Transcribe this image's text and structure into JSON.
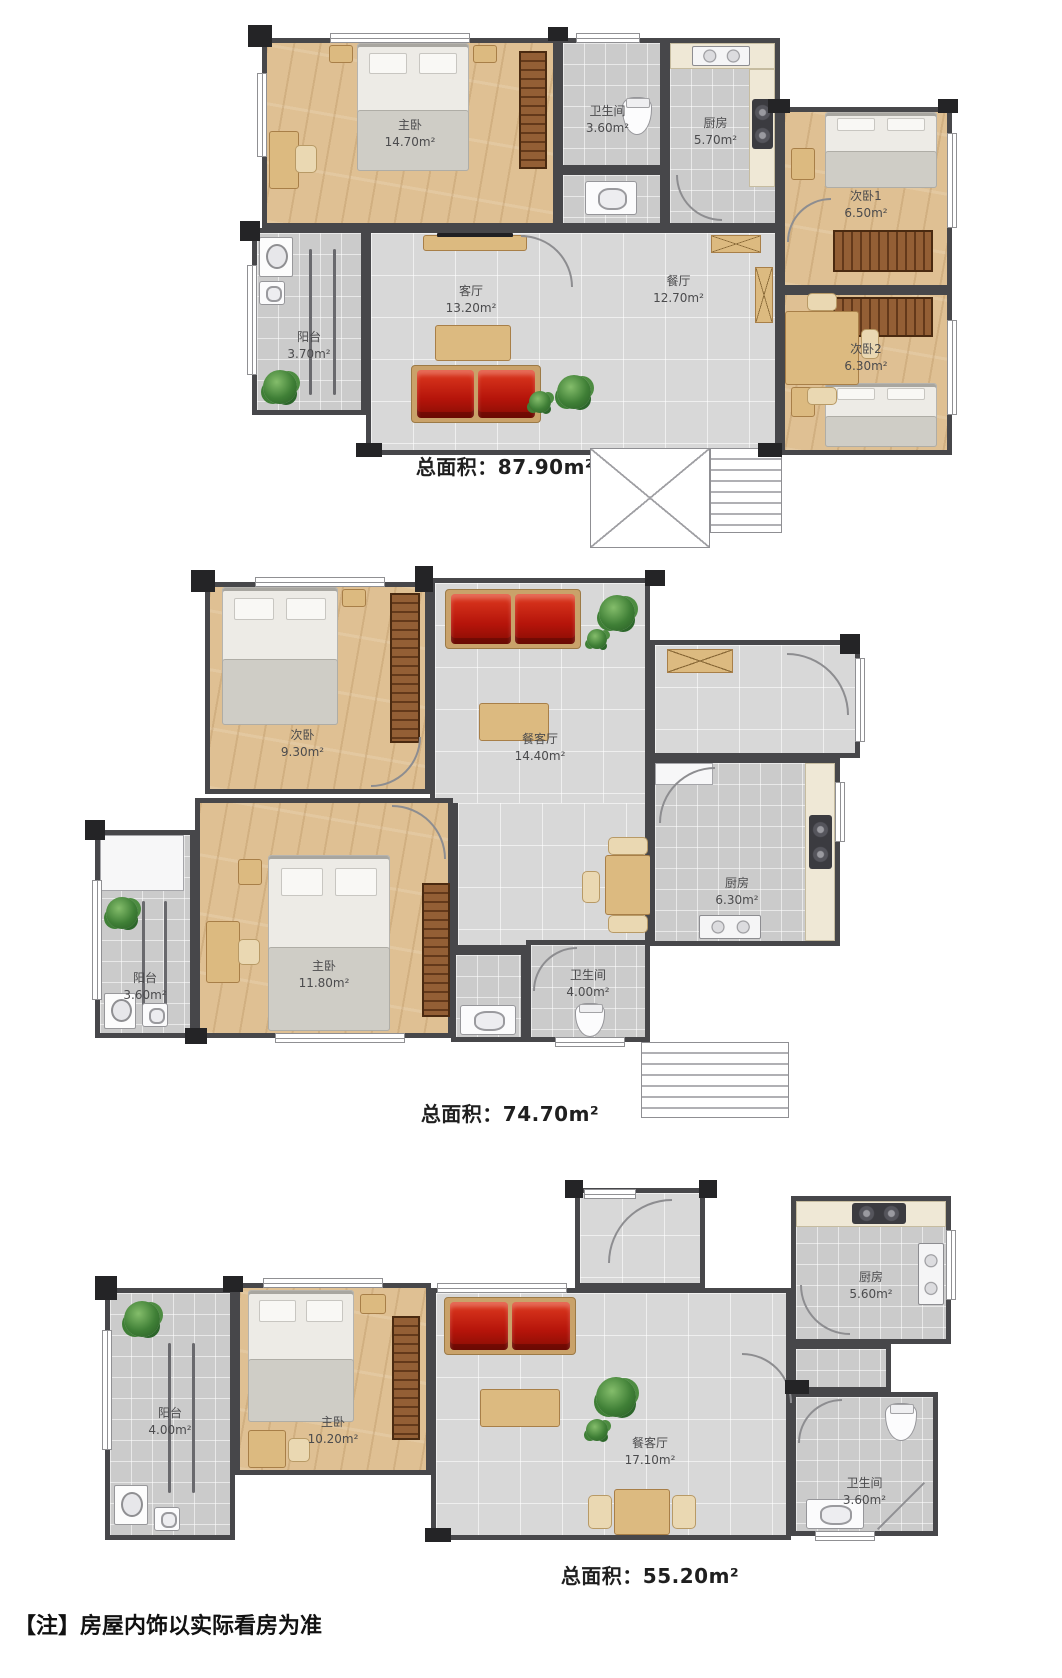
{
  "note": "【注】房屋内饰以实际看房为准",
  "colors": {
    "wall": "#47474a",
    "wood_floor": "#dfc093",
    "tile_floor": "#d8d8d8",
    "bath_tile": "#cbcbcb",
    "sofa": "#b5140a",
    "wood_furniture": "#dcba80",
    "wardrobe": "#935f35",
    "plant": "#3f7f36"
  },
  "plans": [
    {
      "total": "总面积：87.90m²",
      "rooms": {
        "master": {
          "name": "主卧",
          "area": "14.70m²"
        },
        "bath": {
          "name": "卫生间",
          "area": "3.60m²"
        },
        "kitchen": {
          "name": "厨房",
          "area": "5.70m²"
        },
        "bed1": {
          "name": "次卧1",
          "area": "6.50m²"
        },
        "bed2": {
          "name": "次卧2",
          "area": "6.30m²"
        },
        "living": {
          "name": "客厅",
          "area": "13.20m²"
        },
        "dining": {
          "name": "餐厅",
          "area": "12.70m²"
        },
        "balcony": {
          "name": "阳台",
          "area": "3.70m²"
        }
      }
    },
    {
      "total": "总面积：74.70m²",
      "rooms": {
        "second": {
          "name": "次卧",
          "area": "9.30m²"
        },
        "living": {
          "name": "餐客厅",
          "area": "14.40m²"
        },
        "kitchen": {
          "name": "厨房",
          "area": "6.30m²"
        },
        "master": {
          "name": "主卧",
          "area": "11.80m²"
        },
        "balcony": {
          "name": "阳台",
          "area": "3.60m²"
        },
        "bath": {
          "name": "卫生间",
          "area": "4.00m²"
        }
      }
    },
    {
      "total": "总面积：55.20m²",
      "rooms": {
        "balcony": {
          "name": "阳台",
          "area": "4.00m²"
        },
        "master": {
          "name": "主卧",
          "area": "10.20m²"
        },
        "living": {
          "name": "餐客厅",
          "area": "17.10m²"
        },
        "kitchen": {
          "name": "厨房",
          "area": "5.60m²"
        },
        "bath": {
          "name": "卫生间",
          "area": "3.60m²"
        }
      }
    }
  ]
}
